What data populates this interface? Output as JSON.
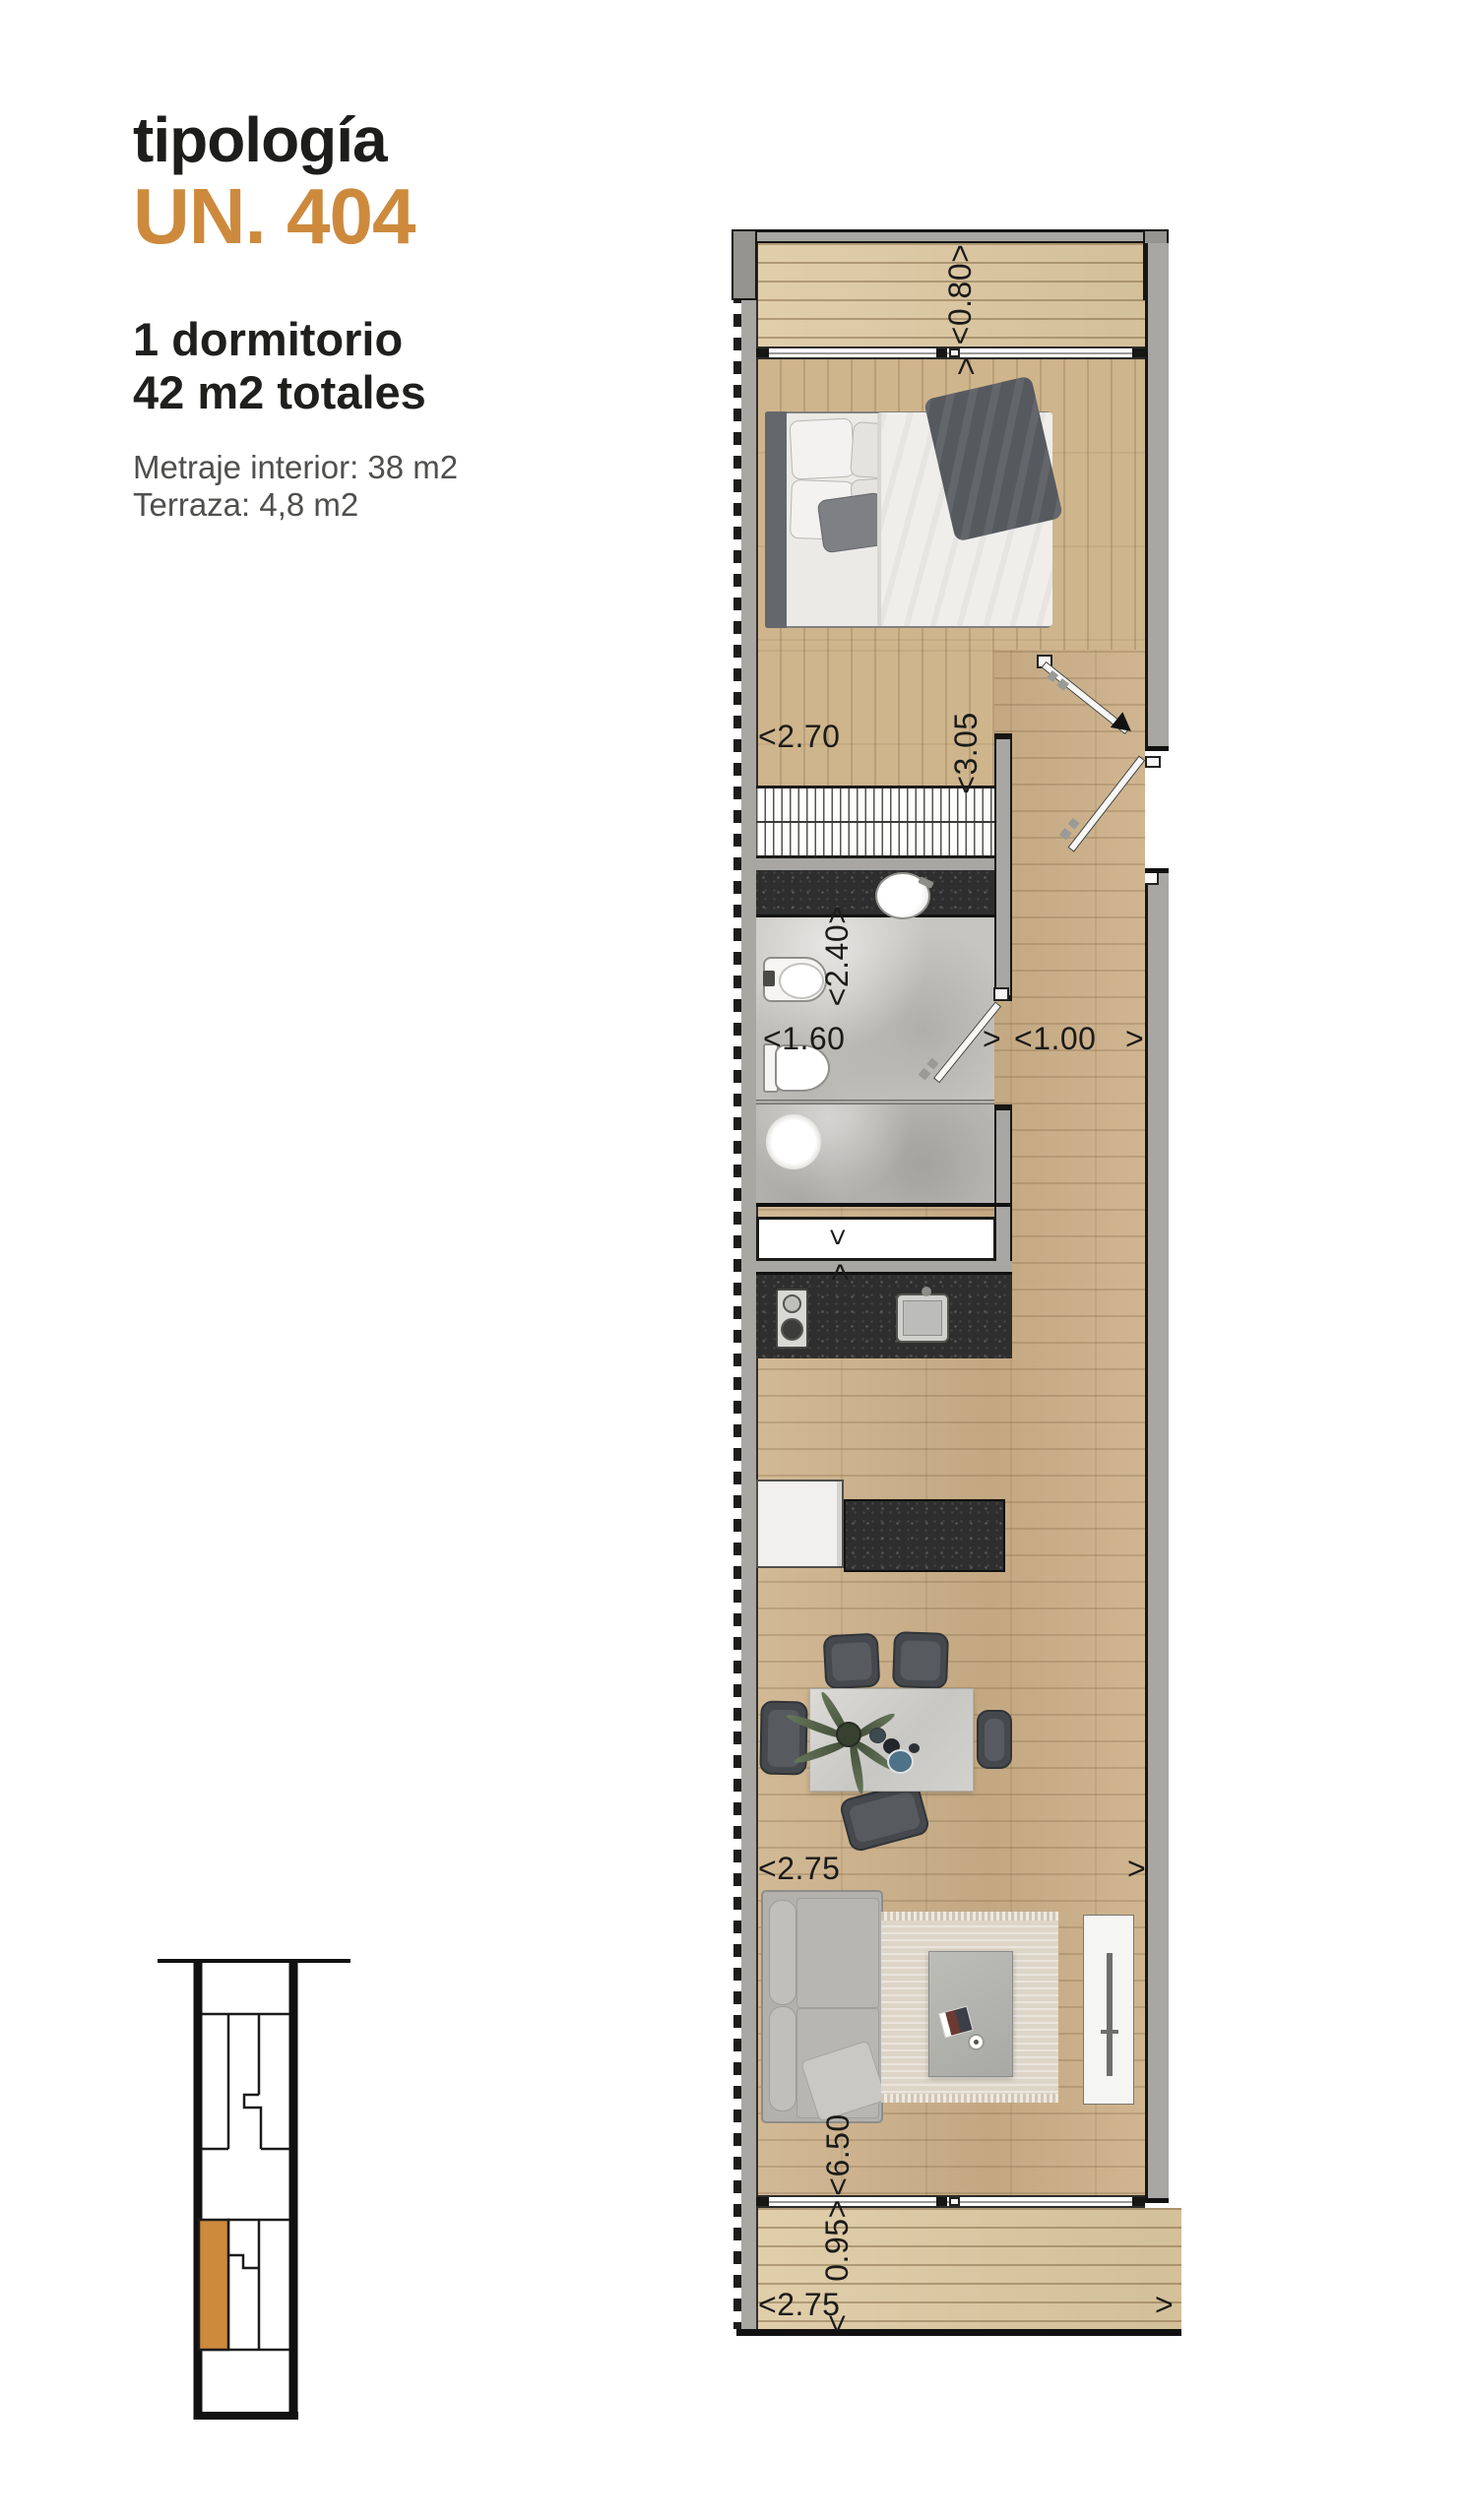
{
  "header": {
    "kicker": "tipología",
    "unit_number": "UN. 404",
    "summary_line1": "1 dormitorio",
    "summary_line2": "42 m2 totales",
    "detail_line1": "Metraje interior: 38 m2",
    "detail_line2": "Terraza: 4,8 m2"
  },
  "colors": {
    "accent_orange": "#cd8a3d",
    "text_dark": "#1d1d1b",
    "text_gray": "#4f4f4d",
    "wall_gray": "#a9a7a3",
    "counter_dark": "#2e2e2e",
    "wood_floor": "#cdb189",
    "deck_wood": "#dcc79f"
  },
  "plan": {
    "dimensions": {
      "terrace_top_depth": "<0.80>",
      "bedroom_width": "<2.70",
      "bedroom_length": "<3.05",
      "bedroom_length_top_arrow": ">",
      "bathroom_length": "<2.40>",
      "bathroom_width": "<1.60",
      "bathroom_width_right_arrow": ">",
      "hall_width": "<1.00",
      "hall_width_right_arrow": ">",
      "living_width": "<2.75",
      "living_width_right_arrow": ">",
      "living_length": "<6.50",
      "living_length_top_arrow": ">",
      "terrace_bottom_depth": "0.95>",
      "terrace_bottom_depth_bottom_arrow": "<",
      "terrace_bottom_width": "<2.75",
      "terrace_bottom_width_right_arrow": ">",
      "closet_swing_chevron": ">"
    }
  }
}
